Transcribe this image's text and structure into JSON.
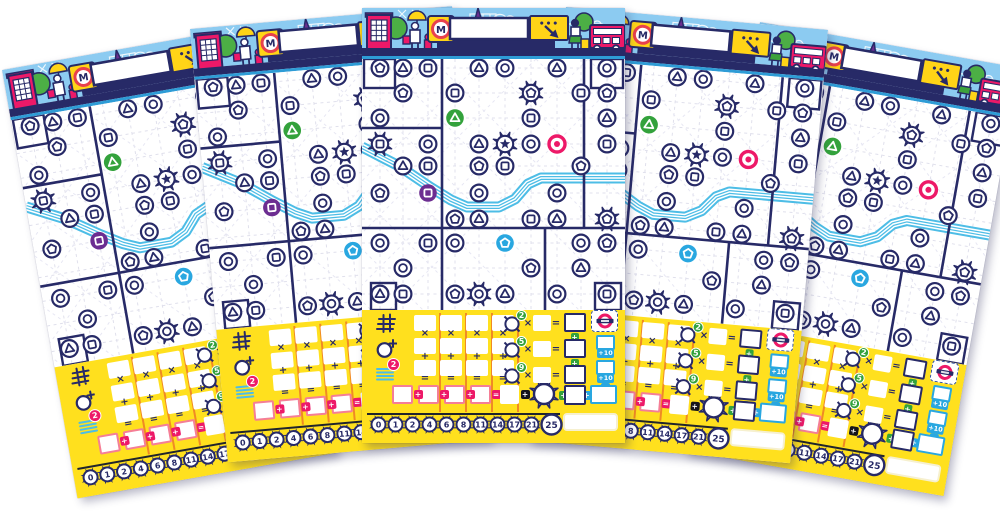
{
  "scene": {
    "width": 1000,
    "height": 511,
    "background": "#FFFFFF"
  },
  "colors": {
    "navy": "#272A67",
    "sky": "#8CCBF1",
    "yellow": "#FFE01E",
    "accent_yellow": "#FFD417",
    "magenta": "#ED1968",
    "green": "#33A23C",
    "tree_green": "#4CAF45",
    "purple": "#6C2D91",
    "blue": "#29A7E0",
    "river": "#4DBDE6",
    "orange_divider": "#F08A24",
    "lattice": "#E0E0EC",
    "result_border": "#F57E96",
    "bar_blue": "#2E9CD6",
    "sign_red": "#E8414D"
  },
  "sheet": {
    "header": {
      "metro_label": "M",
      "bubble_dots": "•••",
      "name_value": ""
    },
    "grid": {
      "cols": [
        18,
        41,
        66,
        93,
        117,
        143,
        169,
        195,
        219,
        245
      ],
      "rows": [
        9,
        34,
        59,
        85,
        107,
        134,
        160,
        184,
        209,
        235
      ],
      "district_lines": [
        {
          "x1": 80,
          "y1": 0,
          "x2": 80,
          "y2": 251
        },
        {
          "x1": 222,
          "y1": 0,
          "x2": 222,
          "y2": 169
        },
        {
          "x1": 183,
          "y1": 169,
          "x2": 183,
          "y2": 251
        },
        {
          "x1": 0,
          "y1": 169,
          "x2": 263,
          "y2": 169
        },
        {
          "x1": 0,
          "y1": 69,
          "x2": 80,
          "y2": 69
        }
      ],
      "corner_boxes": [
        [
          2,
          0,
          31,
          29
        ],
        [
          229,
          0,
          32,
          29
        ],
        [
          9,
          224,
          25,
          27
        ],
        [
          233,
          224,
          26,
          27
        ]
      ],
      "river": [
        [
          0,
          88
        ],
        [
          37,
          107
        ],
        [
          68,
          128
        ],
        [
          89,
          141
        ],
        [
          105,
          148
        ],
        [
          137,
          148
        ],
        [
          153,
          140
        ],
        [
          166,
          125
        ],
        [
          179,
          119
        ],
        [
          263,
          119
        ]
      ],
      "stations": [
        {
          "c": 0,
          "r": 0,
          "s": "pentagon",
          "v": "normal"
        },
        {
          "c": 1,
          "r": 0,
          "s": "triangle",
          "v": "normal"
        },
        {
          "c": 2,
          "r": 0,
          "s": "square",
          "v": "normal"
        },
        {
          "c": 4,
          "r": 0,
          "s": "triangle",
          "v": "normal"
        },
        {
          "c": 5,
          "r": 0,
          "s": "circle",
          "v": "normal"
        },
        {
          "c": 7,
          "r": 0,
          "s": "triangle",
          "v": "normal"
        },
        {
          "c": 9,
          "r": 0,
          "s": "circle",
          "v": "normal"
        },
        {
          "c": 1,
          "r": 1,
          "s": "pentagon",
          "v": "normal"
        },
        {
          "c": 3,
          "r": 1,
          "s": "square",
          "v": "normal"
        },
        {
          "c": 6,
          "r": 1,
          "s": "pentagon",
          "v": "special"
        },
        {
          "c": 8,
          "r": 1,
          "s": "square",
          "v": "normal"
        },
        {
          "c": 9,
          "r": 1,
          "s": "pentagon",
          "v": "normal"
        },
        {
          "c": 0,
          "r": 2,
          "s": "circle",
          "v": "normal"
        },
        {
          "c": 3,
          "r": 2,
          "s": "triangle",
          "v": "green"
        },
        {
          "c": 6,
          "r": 2,
          "s": "square",
          "v": "normal"
        },
        {
          "c": 9,
          "r": 2,
          "s": "triangle",
          "v": "normal"
        },
        {
          "c": 0,
          "r": 3,
          "s": "square",
          "v": "special"
        },
        {
          "c": 2,
          "r": 3,
          "s": "circle",
          "v": "normal"
        },
        {
          "c": 4,
          "r": 3,
          "s": "triangle",
          "v": "normal"
        },
        {
          "c": 5,
          "r": 3,
          "s": "star",
          "v": "special"
        },
        {
          "c": 6,
          "r": 3,
          "s": "circle",
          "v": "normal"
        },
        {
          "c": 7,
          "r": 3,
          "s": "circle",
          "v": "pink"
        },
        {
          "c": 9,
          "r": 3,
          "s": "square",
          "v": "normal"
        },
        {
          "c": 1,
          "r": 4,
          "s": "triangle",
          "v": "normal"
        },
        {
          "c": 2,
          "r": 4,
          "s": "square",
          "v": "normal"
        },
        {
          "c": 4,
          "r": 4,
          "s": "pentagon",
          "v": "normal"
        },
        {
          "c": 5,
          "r": 4,
          "s": "square",
          "v": "normal"
        },
        {
          "c": 8,
          "r": 4,
          "s": "pentagon",
          "v": "normal"
        },
        {
          "c": 0,
          "r": 5,
          "s": "pentagon",
          "v": "normal"
        },
        {
          "c": 2,
          "r": 5,
          "s": "square",
          "v": "purple"
        },
        {
          "c": 4,
          "r": 5,
          "s": "circle",
          "v": "normal"
        },
        {
          "c": 7,
          "r": 5,
          "s": "circle",
          "v": "normal"
        },
        {
          "c": 3,
          "r": 6,
          "s": "pentagon",
          "v": "normal"
        },
        {
          "c": 4,
          "r": 6,
          "s": "triangle",
          "v": "normal"
        },
        {
          "c": 6,
          "r": 6,
          "s": "square",
          "v": "normal"
        },
        {
          "c": 7,
          "r": 6,
          "s": "triangle",
          "v": "normal"
        },
        {
          "c": 9,
          "r": 6,
          "s": "pentagon",
          "v": "special"
        },
        {
          "c": 0,
          "r": 7,
          "s": "circle",
          "v": "normal"
        },
        {
          "c": 2,
          "r": 7,
          "s": "square",
          "v": "normal"
        },
        {
          "c": 3,
          "r": 7,
          "s": "circle",
          "v": "normal"
        },
        {
          "c": 5,
          "r": 7,
          "s": "pentagon",
          "v": "blue"
        },
        {
          "c": 8,
          "r": 7,
          "s": "circle",
          "v": "normal"
        },
        {
          "c": 9,
          "r": 7,
          "s": "pentagon",
          "v": "normal"
        },
        {
          "c": 1,
          "r": 8,
          "s": "circle",
          "v": "normal"
        },
        {
          "c": 6,
          "r": 8,
          "s": "pentagon",
          "v": "normal"
        },
        {
          "c": 8,
          "r": 8,
          "s": "triangle",
          "v": "normal"
        },
        {
          "c": 0,
          "r": 9,
          "s": "triangle",
          "v": "normal"
        },
        {
          "c": 1,
          "r": 9,
          "s": "square",
          "v": "normal"
        },
        {
          "c": 3,
          "r": 9,
          "s": "pentagon",
          "v": "normal"
        },
        {
          "c": 4,
          "r": 9,
          "s": "circle",
          "v": "special"
        },
        {
          "c": 5,
          "r": 9,
          "s": "triangle",
          "v": "normal"
        },
        {
          "c": 7,
          "r": 9,
          "s": "circle",
          "v": "normal"
        },
        {
          "c": 9,
          "r": 9,
          "s": "square",
          "v": "normal"
        }
      ]
    },
    "scoring": {
      "multiply": "×",
      "plus": "+",
      "equals": "=",
      "formula_columns": 4,
      "river_badge": "2",
      "bottom_connectors": [
        "+",
        "+",
        "+",
        "=",
        "+",
        "+",
        "+"
      ],
      "interchange_rows": [
        {
          "badge": "2"
        },
        {
          "badge": "5"
        },
        {
          "badge": "9"
        }
      ],
      "bonus_tags": [
        "+10",
        "+10"
      ],
      "bonus_equals": "=",
      "track": [
        "0",
        "1",
        "2",
        "4",
        "6",
        "8",
        "11",
        "14",
        "17",
        "21",
        "25"
      ]
    }
  },
  "sheets": [
    {
      "x": 2,
      "y": 70,
      "rot": -10,
      "z": 1
    },
    {
      "x": 190,
      "y": 29,
      "rot": -5,
      "z": 2
    },
    {
      "x": 362,
      "y": 8,
      "rot": 0,
      "z": 5
    },
    {
      "x": 566,
      "y": 7,
      "rot": 5,
      "z": 4
    },
    {
      "x": 760,
      "y": 22,
      "rot": 10,
      "z": 3
    }
  ]
}
